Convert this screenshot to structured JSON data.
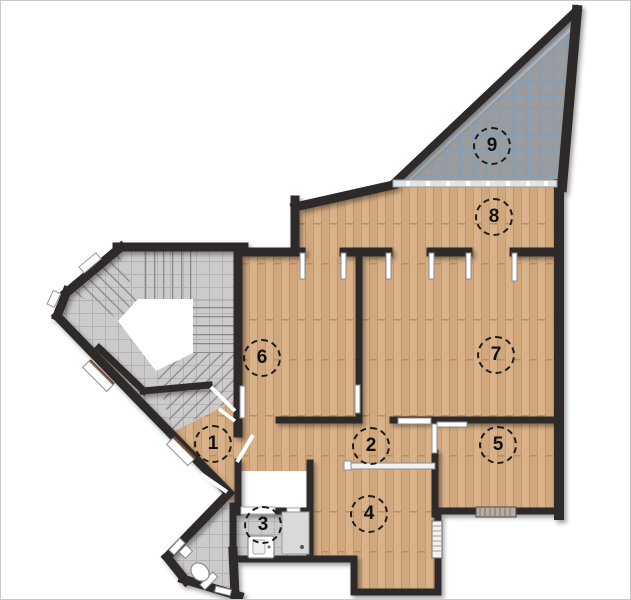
{
  "plan": {
    "type": "floor-plan",
    "title": "Apartment floor plan",
    "rooms": [
      {
        "number": "1",
        "cx": 212,
        "cy": 443
      },
      {
        "number": "2",
        "cx": 370,
        "cy": 445
      },
      {
        "number": "3",
        "cx": 262,
        "cy": 524
      },
      {
        "number": "4",
        "cx": 368,
        "cy": 513
      },
      {
        "number": "5",
        "cx": 497,
        "cy": 444
      },
      {
        "number": "6",
        "cx": 261,
        "cy": 357
      },
      {
        "number": "7",
        "cx": 495,
        "cy": 354
      },
      {
        "number": "8",
        "cx": 493,
        "cy": 216
      },
      {
        "number": "9",
        "cx": 491,
        "cy": 145
      }
    ],
    "colors": {
      "wall": "#2e2b29",
      "wood_floor": "#d6ad83",
      "tile_floor": "#cccbc9",
      "terrace_floor": "#98999b",
      "terrace_grid": "#7ba3c9",
      "door_leaf": "#ffffff",
      "label_text": "#111111"
    }
  }
}
